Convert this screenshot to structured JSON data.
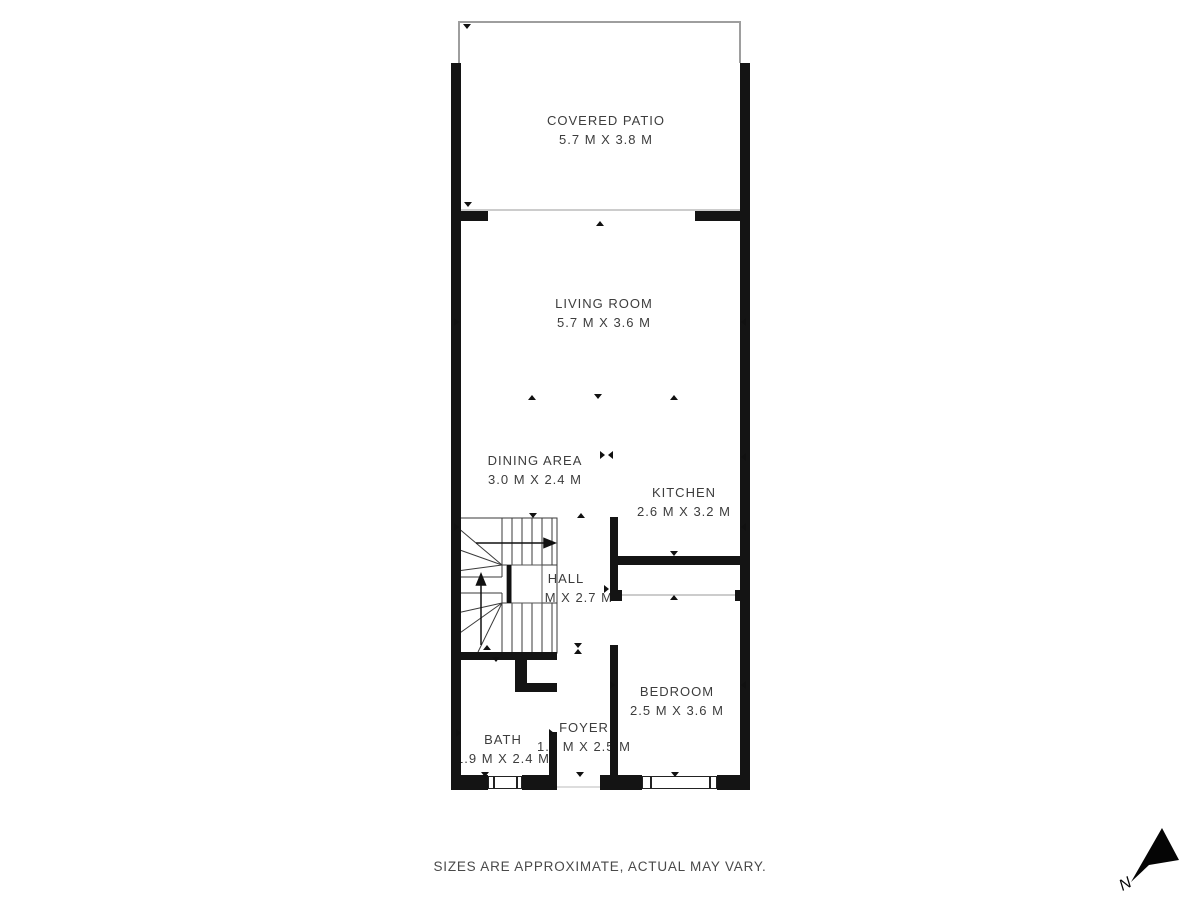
{
  "plan": {
    "rooms": [
      {
        "name": "COVERED PATIO",
        "dims": "5.7 M X 3.8 M"
      },
      {
        "name": "LIVING ROOM",
        "dims": "5.7 M X 3.6 M"
      },
      {
        "name": "DINING AREA",
        "dims": "3.0 M X 2.4 M"
      },
      {
        "name": "KITCHEN",
        "dims": "2.6 M X 3.2 M"
      },
      {
        "name": "HALL",
        "dims": "2.0 M X 2.7 M"
      },
      {
        "name": "BEDROOM",
        "dims": "2.5 M X 3.6 M"
      },
      {
        "name": "FOYER",
        "dims": "1.1 M X 2.5 M"
      },
      {
        "name": "BATH",
        "dims": "1.9 M X 2.4 M"
      }
    ],
    "disclaimer": "SIZES ARE APPROXIMATE, ACTUAL MAY VARY.",
    "compass_label": "N",
    "colors": {
      "wall": "#141414",
      "patio_outline": "#9e9e9e",
      "opening_line": "#cccccc",
      "label_text": "#3d3d3d"
    }
  }
}
